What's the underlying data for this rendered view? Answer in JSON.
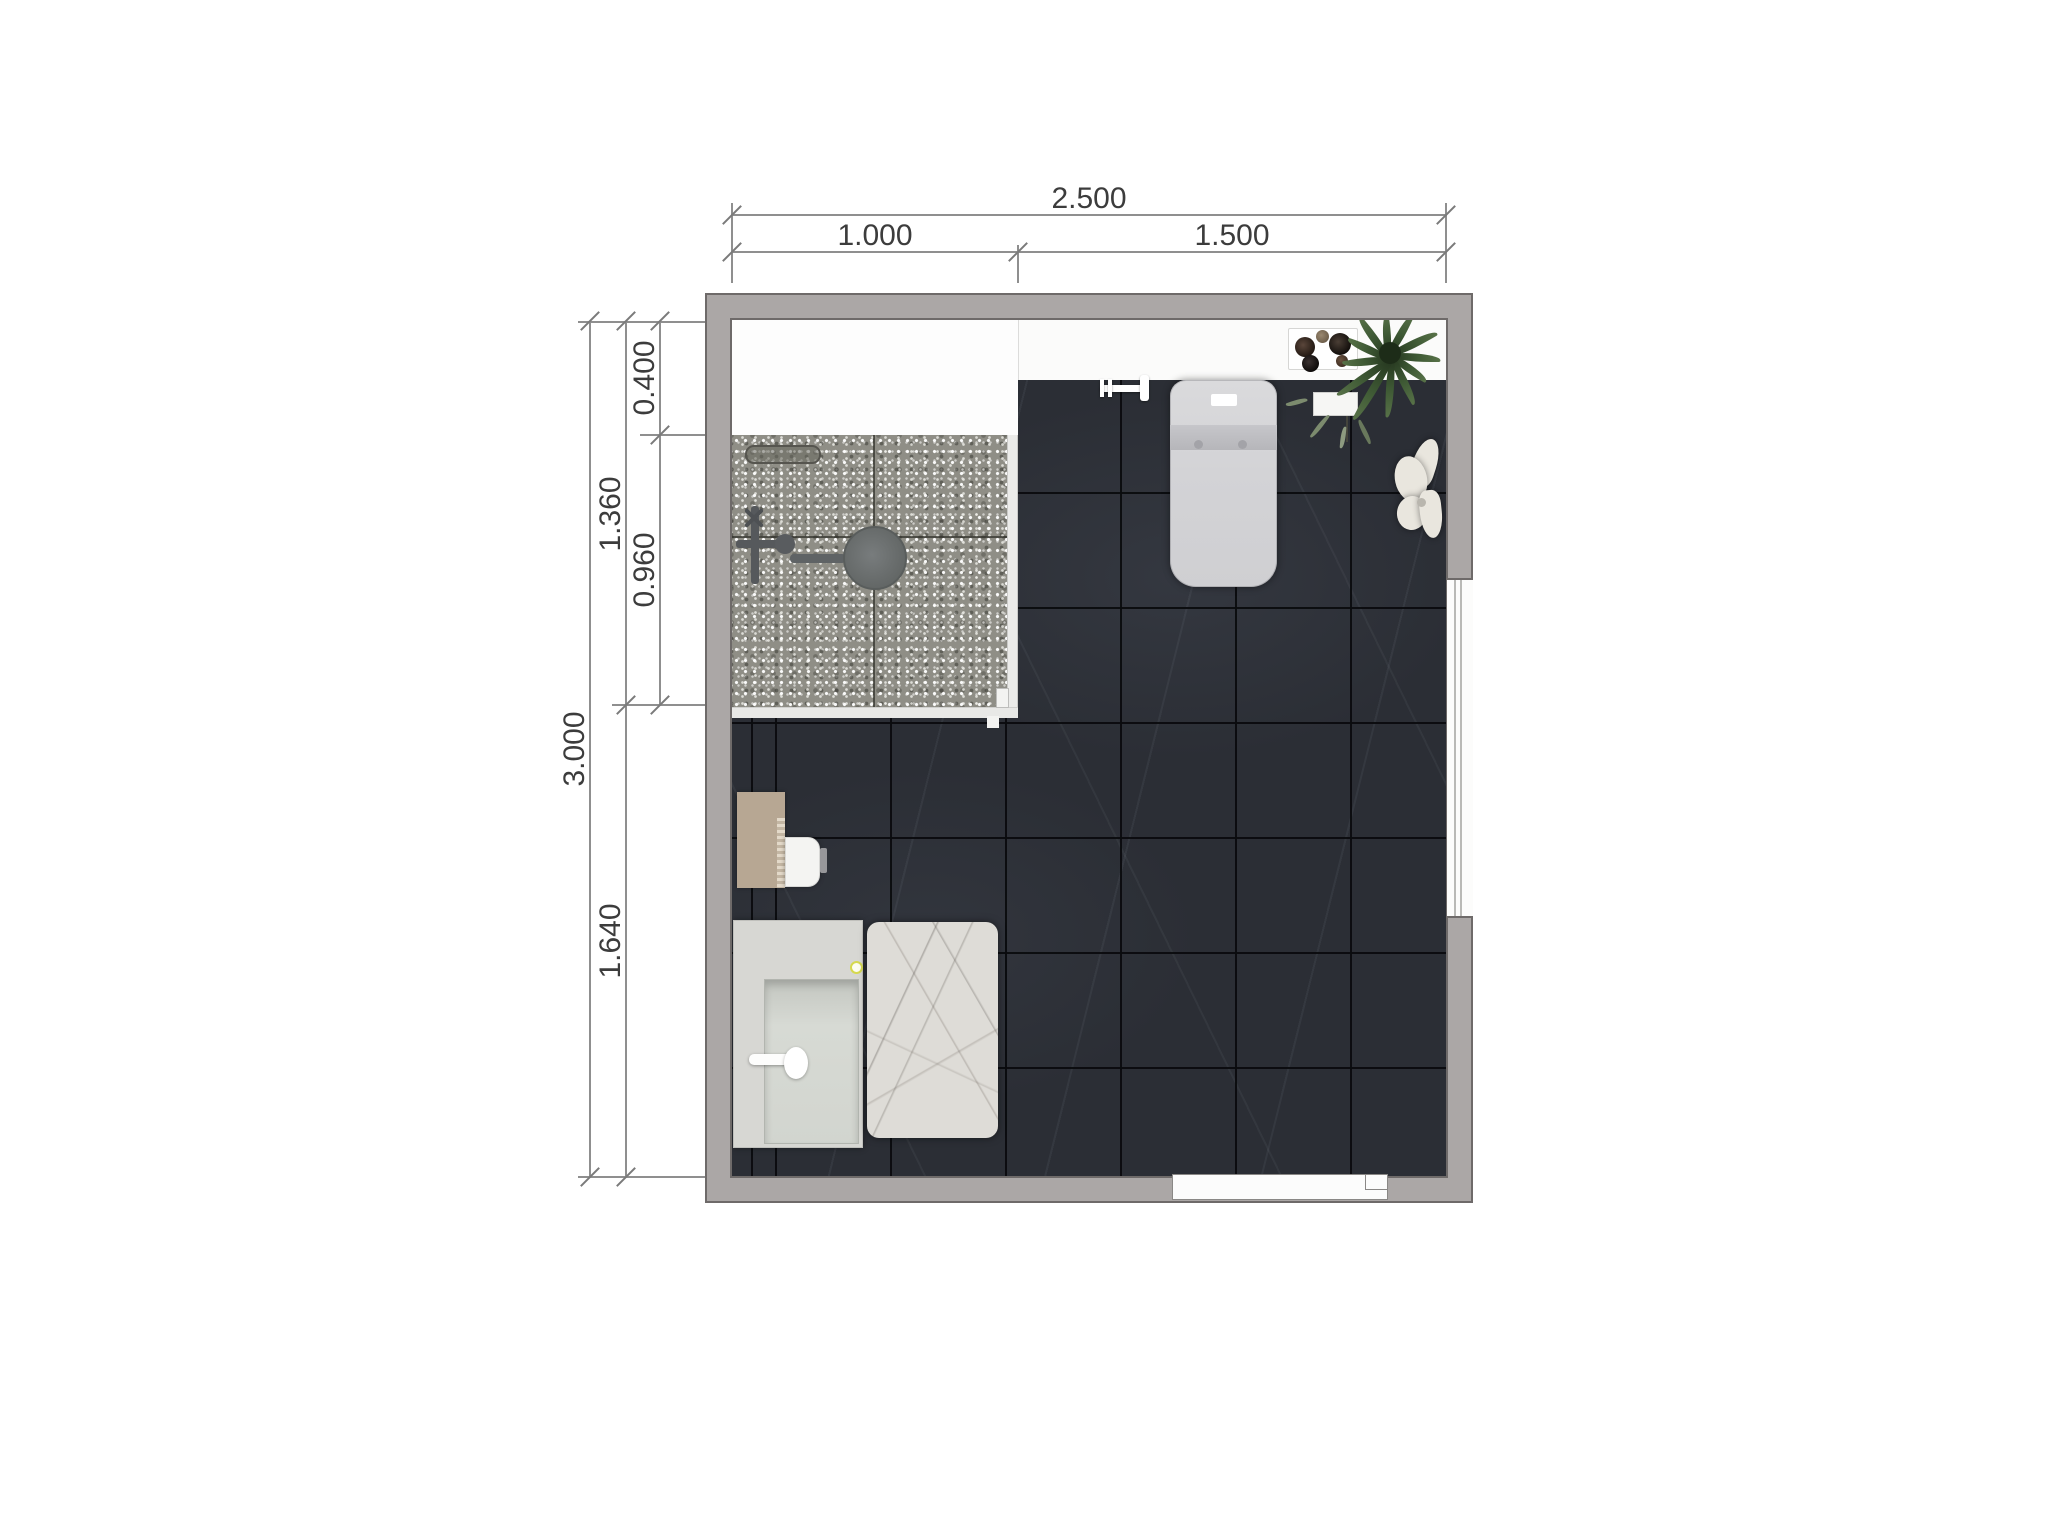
{
  "document": {
    "type": "bathroom-floor-plan"
  },
  "dimensions": {
    "top": {
      "total": "2.500",
      "left_segment": "1.000",
      "right_segment": "1.500"
    },
    "left": {
      "total": "3.000",
      "upper_total": "1.360",
      "top_ledge": "0.400",
      "shower_depth": "0.960",
      "lower": "1.640"
    }
  },
  "colors": {
    "wall": "#aba7a6",
    "floor_tile": "#2b2e35",
    "shower_floor": "#8f8e86",
    "marble_mat": "#dedcd7",
    "cabinet_tan": "#b7a793",
    "plant_green": "#3f5a35",
    "dim_line": "#8f8f8f",
    "dim_text": "#3c3c3c"
  },
  "fixtures": {
    "shower": "walk-in-shower",
    "drain": "floor-drain",
    "shower_head": "rain-shower-head",
    "mixer": "shower-mixer",
    "glass": "glass-partition",
    "toilet": "one-piece-toilet",
    "wall_faucet": "wall-faucet",
    "vanity": "sink-vanity",
    "mat": "marble-bath-mat",
    "cabinet": "side-cabinet",
    "paper_holder": "paper-holder",
    "plant": "potted-fern",
    "tray": "pebble-tray",
    "flower": "towel-flower-decor",
    "window": "window",
    "door": "door"
  }
}
